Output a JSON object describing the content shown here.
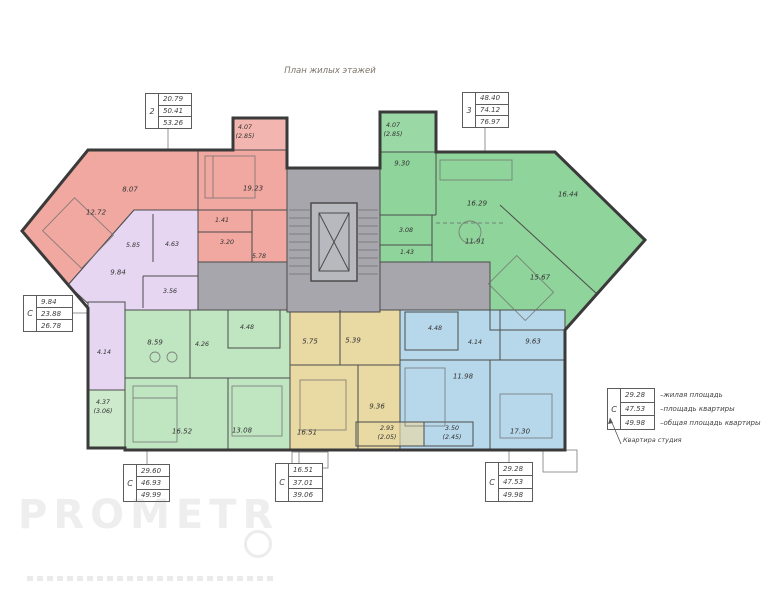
{
  "title": "План жилых этажей",
  "watermark": "PROMETR",
  "colors": {
    "pink": "#f0a8a1",
    "purple": "#e6d6f2",
    "green": "#8fd49b",
    "light_green": "#c0e5c1",
    "yellow": "#e9d9a3",
    "blue": "#b7d7ea",
    "gray": "#a6a6ac",
    "gray_light": "#b8b8bf",
    "wall": "#3a3a3a"
  },
  "info_boxes": {
    "apt2": {
      "label": "2",
      "rows": [
        "20.79",
        "50.41",
        "53.26"
      ]
    },
    "apt3": {
      "label": "3",
      "rows": [
        "48.40",
        "74.12",
        "76.97"
      ]
    },
    "studio_left": {
      "label": "С",
      "rows": [
        "9.84",
        "23.88",
        "26.78"
      ]
    },
    "bottom_left": {
      "label": "С",
      "rows": [
        "29.60",
        "46.93",
        "49.99"
      ]
    },
    "bottom_mid": {
      "label": "С",
      "rows": [
        "16.51",
        "37.01",
        "39.06"
      ]
    },
    "bottom_right": {
      "label": "С",
      "rows": [
        "29.28",
        "47.53",
        "49.98"
      ]
    }
  },
  "legend": {
    "label": "С",
    "rows": [
      {
        "value": "29.28",
        "desc": "–жилая площадь"
      },
      {
        "value": "47.53",
        "desc": "–площадь квартиры"
      },
      {
        "value": "49.98",
        "desc": "–общая площадь квартиры"
      }
    ],
    "footnote": "Квартира студия"
  },
  "room_labels": [
    "12.72",
    "8.07",
    "19.23",
    "1.41",
    "3.20",
    "5.78",
    "4.07",
    "(2.85)",
    "5.85",
    "4.63",
    "9.84",
    "3.56",
    "4.14",
    "9.30",
    "16.29",
    "16.44",
    "3.08",
    "1.43",
    "11.91",
    "15.67",
    "4.07",
    "(2.85)",
    "8.59",
    "4.26",
    "4.48",
    "16.52",
    "13.08",
    "4.37",
    "(3.06)",
    "5.75",
    "5.39",
    "16.51",
    "9.36",
    "2.93",
    "(2.05)",
    "4.48",
    "4.14",
    "9.63",
    "11.98",
    "17.30",
    "3.50",
    "(2.45)"
  ]
}
